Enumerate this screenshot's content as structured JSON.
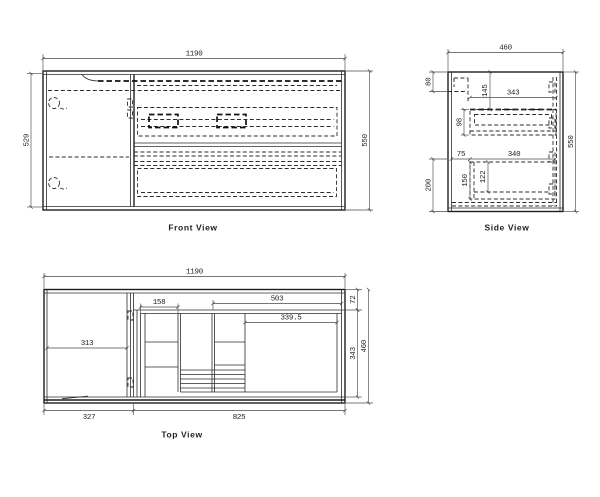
{
  "front_view": {
    "label": "Front View",
    "dim_width": "1190",
    "dim_height_left": "529",
    "dim_height_right": "550"
  },
  "side_view": {
    "label": "Side View",
    "dim_width": "460",
    "dim_height": "550",
    "dim_top_thickness": "80",
    "dim_basin_depth": "145",
    "dim_top_drawer_width": "343",
    "dim_top_drawer_height": "98",
    "dim_front_offset": "75",
    "dim_bottom_drawer_width": "340",
    "dim_bottom_section": "200",
    "dim_bottom_drawer_height": "150",
    "dim_inner_height": "122"
  },
  "top_view": {
    "label": "Top View",
    "dim_width": "1190",
    "dim_door_width": "313",
    "dim_drawer_inner": "158",
    "dim_right_opening": "503",
    "dim_basin_width": "339.5",
    "dim_back_gap": "72",
    "dim_inner_depth": "343",
    "dim_depth": "460",
    "dim_left_section": "327",
    "dim_right_section": "825"
  }
}
